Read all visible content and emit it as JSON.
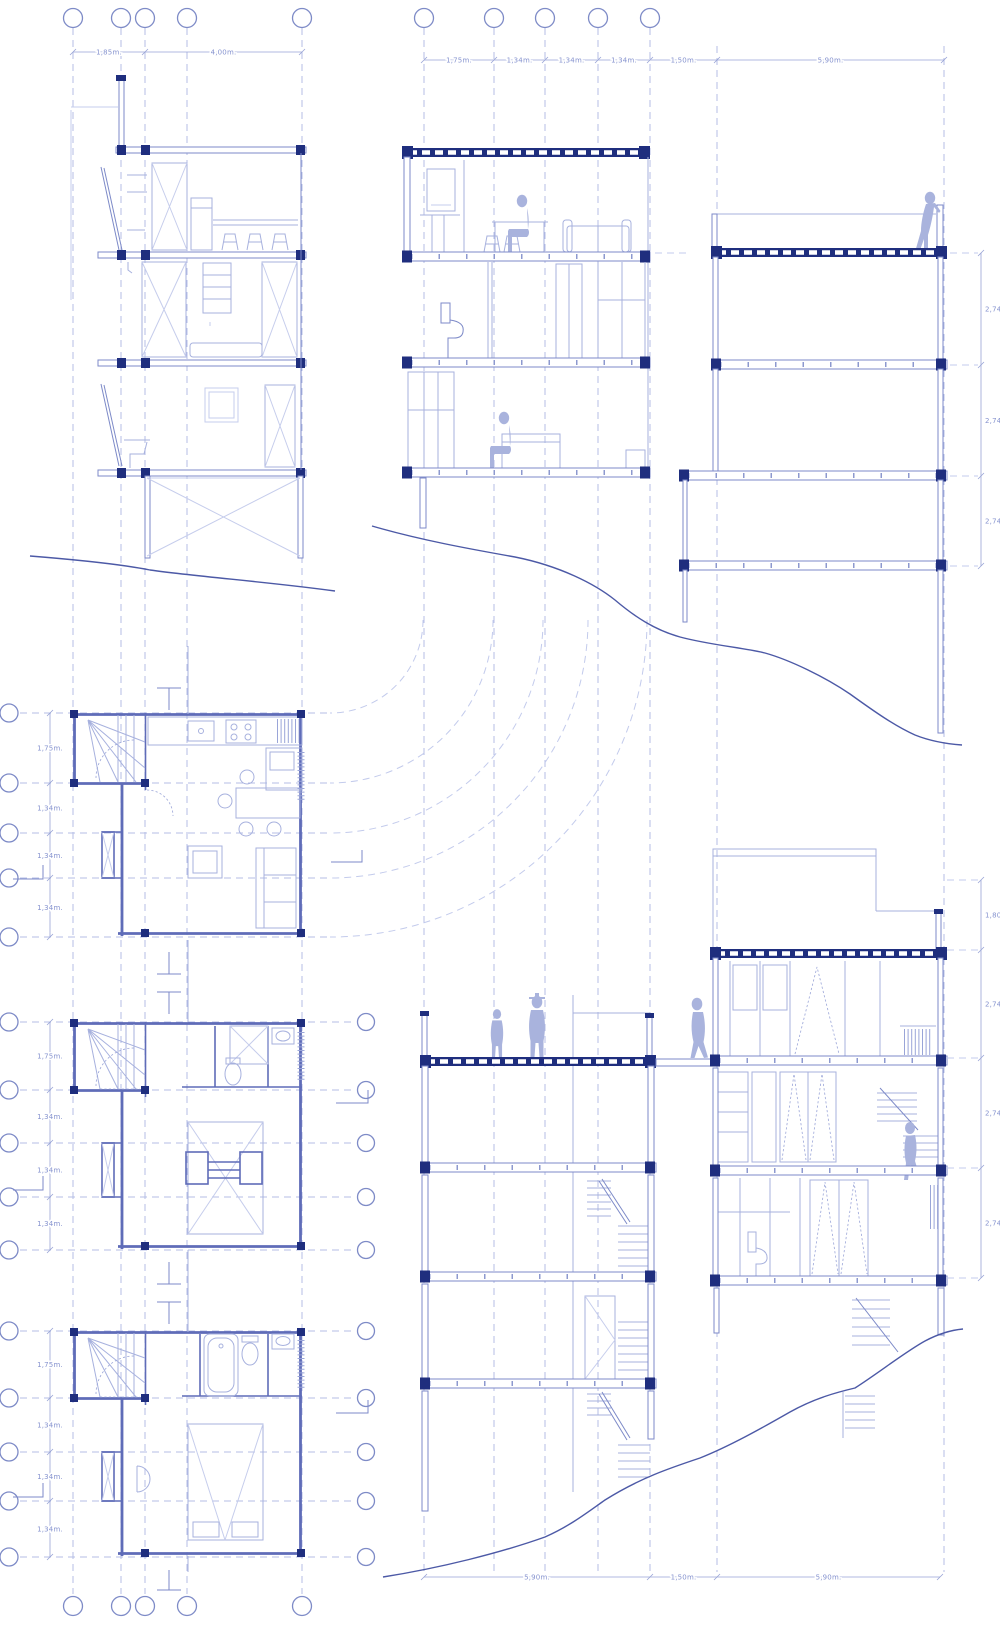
{
  "colors": {
    "paper": "#ffffff",
    "grid_line": "#b4bde6",
    "line_light": "#a7b1de",
    "line_medium": "#7d8ac8",
    "wall": "#5f6cb8",
    "structure_navy": "#1f2e7e",
    "terrain": "#4c59a6",
    "figure_fill": "#a9b3dd",
    "dimension_text": "#8693cf"
  },
  "dims": {
    "top_left": [
      "1,85m.",
      "4,00m."
    ],
    "top_mid": [
      "1,75m.",
      "1,34m.",
      "1,34m.",
      "1,34m.",
      "1,50m.",
      "5,90m."
    ],
    "bottom": [
      "5,90m.",
      "1,50m.",
      "5,90m."
    ],
    "right_upper": [
      "2,74m.",
      "2,74m.",
      "2,74m."
    ],
    "right_lower": [
      "1,80m.",
      "2,74m.",
      "2,74m.",
      "2,74m."
    ],
    "plan1_left": [
      "1,75m.",
      "1,34m.",
      "1,34m.",
      "1,34m."
    ],
    "plan2_left": [
      "1,75m.",
      "1,34m.",
      "1,34m.",
      "1,34m."
    ],
    "plan3_left": [
      "1,75m.",
      "1,34m.",
      "1,34m.",
      "1,34m."
    ]
  }
}
